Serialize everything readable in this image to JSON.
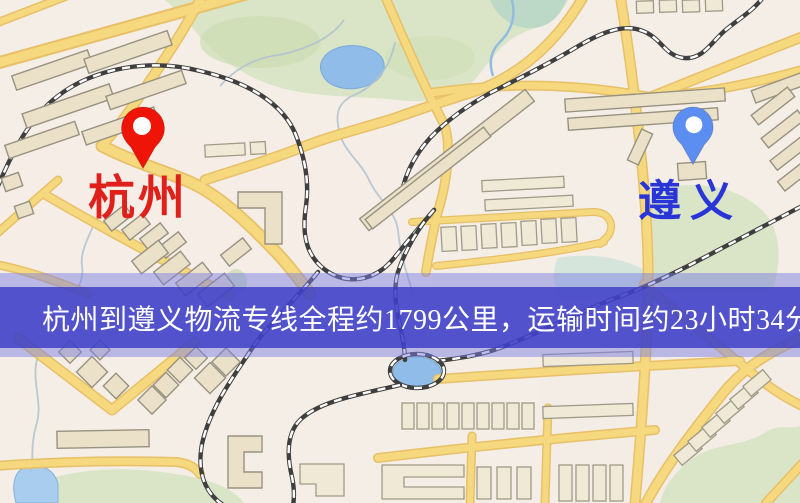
{
  "banner": {
    "text": "杭州到遵义物流专线全程约1799公里，运输时间约23小时34分钟."
  },
  "map": {
    "origin": {
      "label": "杭州"
    },
    "destination": {
      "label": "遵义"
    }
  },
  "colors": {
    "origin-marker": "#ee1408",
    "origin-label": "#e0201a",
    "destination-marker": "#5b8ef0",
    "destination-label": "#2a35d8",
    "banner-outer": "rgba(122,126,228,0.48)",
    "banner-inner": "rgba(56,58,198,0.80)",
    "banner-text": "#ffffff",
    "road-fill": "#f6d87e",
    "road-casing": "#e7c068",
    "building-fill": "#eae1c8",
    "park-fill": "#d9e5c6",
    "water-fill": "#8fbce8",
    "railway-dark": "#3f3f3f"
  }
}
